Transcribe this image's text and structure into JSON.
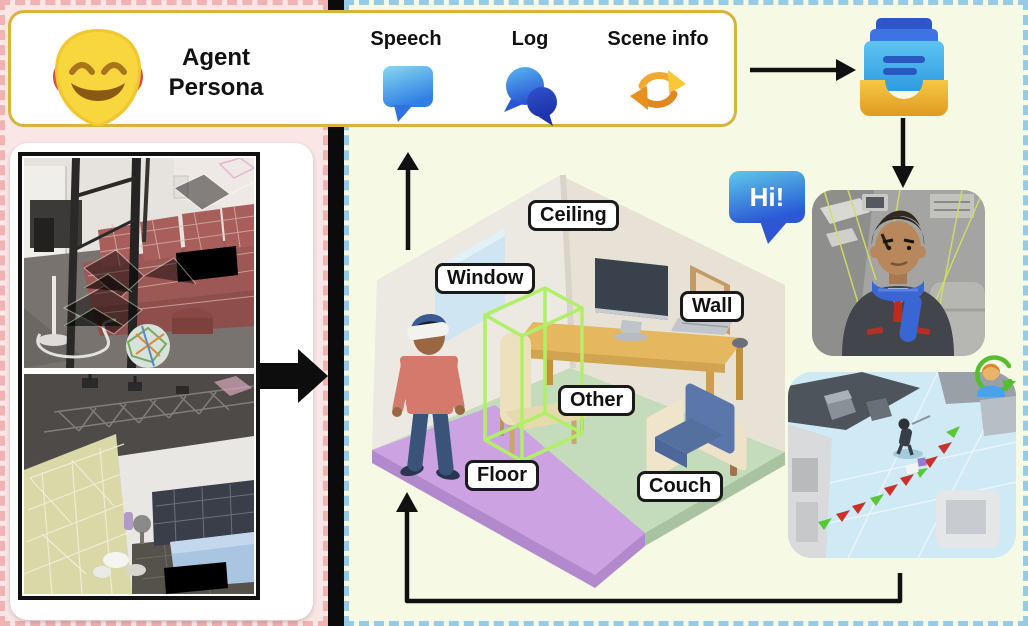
{
  "header": {
    "persona_label": "Agent Persona",
    "mask_icon": "theater-mask-emoji",
    "items": [
      {
        "label": "Speech",
        "icon": "speech-bubble-icon"
      },
      {
        "label": "Log",
        "icon": "chat-bubbles-icon"
      },
      {
        "label": "Scene info",
        "icon": "refresh-arrows-icon"
      }
    ]
  },
  "left_panel": {
    "photos": [
      {
        "name": "real-room-scan-couch",
        "redaction": "black-box"
      },
      {
        "name": "real-room-scan-bedroom",
        "redaction": "black-box"
      }
    ]
  },
  "scene": {
    "greeting": "Hi!",
    "labels": {
      "ceiling": "Ceiling",
      "window": "Window",
      "wall": "Wall",
      "other": "Other",
      "floor": "Floor",
      "couch": "Couch"
    }
  },
  "icons": {
    "storage": "archive-tray-icon",
    "sync": "person-refresh-icon",
    "photo_to_scene_arrow": "fat-right-arrow",
    "flow_arrows": [
      "up-arrow",
      "right-arrow",
      "down-arrow",
      "loop-arrow"
    ]
  },
  "colors": {
    "accent_gold": "#d8b43c",
    "panel_pink": "#fbe6e6",
    "panel_green": "#f6f9e4",
    "divider_black": "#0b0b0b",
    "bubble_blue": "#2f6fdc",
    "floor_green": "#c5dcbc",
    "carpet_purple": "#cda2e2",
    "wireframe_green": "#b2ef68",
    "label_border": "#1a1a1a"
  }
}
